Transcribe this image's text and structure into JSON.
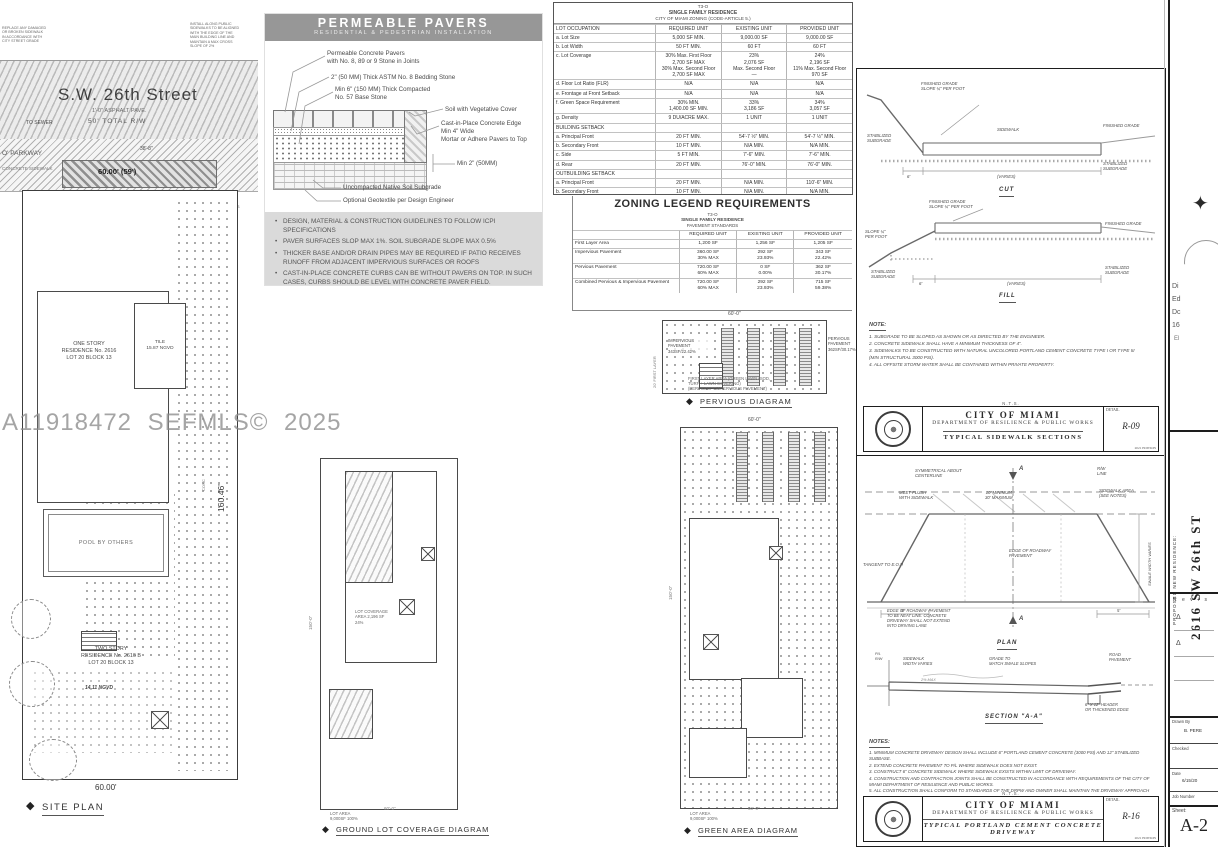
{
  "watermark": "A11918472 SEFMLS© 2025",
  "icons": {
    "diamond": "◆",
    "triangle": "Δ",
    "compass": "✦"
  },
  "site_plan": {
    "note_left": "REPLACE ANY DAMAGED\nOR BROKEN SIDEWALK\nIN ACCORDANCE WITH\nCITY STREET GRADE",
    "note_right": "INSTALL ALONG PUBLIC\nSIDEWALKS TO BE ALIGNED\nWITH THE EDGE OF THE\nMAIN BUILDING LINE AND\nMAINTAIN A MAX CROSS\nSLOPE OF 2%",
    "street_name": "S.W. 26th Street",
    "asphalt": "1'-0\" ASPHALT PAVE.",
    "total_rw": "50' TOTAL R/W",
    "to_sewer": "TO SEWER",
    "parkway": "O' PARKWAY",
    "sidewalk": "CONCRETE SIDEWALK",
    "drive_dim": "60.00' (59')",
    "dim_38": "38'-8\"",
    "drive_ticks": "8'-6\"      8'-6\"      8'-6\"      8'-6\"",
    "vis_triangles": "10'x10'\nVISIBILITY\nTRIANGLES",
    "one_story": "ONE STORY\nRESIDENCE No. 2616\nLOT 20 BLOCK 13",
    "tile": "TILE\n15.87 NGVD",
    "conc": "CONC",
    "pool": "POOL BY OTHERS",
    "two_story": "TWO STORY\nRESIDENCE No. 2616 B\nLOT 20 BLOCK 13",
    "ngvd": "14.11 NGVD",
    "side_dim": "160.46'",
    "bottom_dim": "60.00'",
    "label": "SITE PLAN"
  },
  "pavers": {
    "title": "PERMEABLE PAVERS",
    "subtitle": "RESIDENTIAL & PEDESTRIAN INSTALLATION",
    "callout_pavers": "Permeable Concrete Pavers\nwith No. 8, 89 or 9 Stone in Joints",
    "callout_bedding": "2\" (50 MM) Thick ASTM No. 8 Bedding Stone",
    "callout_base": "Min 6\" (150 MM) Thick Compacted\nNo. 57 Base Stone",
    "callout_soil": "Soil with Vegetative Cover",
    "callout_edge": "Cast-in-Place Concrete Edge\nMin 4\" Wide\nMortar or Adhere Pavers to Top",
    "callout_min2": "Min 2\" (50MM)",
    "callout_subgrade": "Uncompacted Native Soil Subgrade",
    "callout_geotextile": "Optional Geotextile per Design Engineer",
    "bullets": [
      "DESIGN, MATERIAL & CONSTRUCTION GUIDELINES TO FOLLOW ICPI SPECIFICATIONS",
      "PAVER SURFACES SLOP MAX 1%. SOIL SUBGRADE SLOPE MAX 0.5%",
      "THICKER BASE AND/OR DRAIN PIPES MAY BE REQUIRED IF PATIO RECEIVES RUNOFF FROM ADJACENT IMPERVIOUS SURFACES OR ROOFS",
      "CAST-IN-PLACE CONCRETE CURBS CAN BE WITHOUT PAVERS ON TOP. IN SUCH CASES, CURBS SHOULD BE LEVEL WITH CONCRETE PAVER FIELD."
    ]
  },
  "zoning_table": {
    "title1": "T3-O",
    "title2": "SINGLE FAMILY RESIDENCE",
    "title3": "CITY OF MIAMI ZONING (CODE-ARTICLE 5.)",
    "rows": [
      {
        "n": "LOT OCCUPATION",
        "r": "REQUIRED   UNIT",
        "e": "EXISTING   UNIT",
        "p": "PROVIDED   UNIT"
      },
      {
        "n": "a. Lot Size",
        "r": "5,000 SF MIN.",
        "e": "9,000.00 SF",
        "p": "9,000.00 SF"
      },
      {
        "n": "b. Lot Width",
        "r": "50 FT MIN.",
        "e": "60 FT",
        "p": "60 FT"
      },
      {
        "n": "c. Lot Coverage",
        "r": "30% Max. First Floor\n2,700 SF MAX\n30% Max. Second Floor\n2,700 SF MAX",
        "e": "23%\n2,076 SF\nMax. Second Floor\n—",
        "p": "24%\n2,196 SF\n11% Max. Second Floor\n970 SF"
      },
      {
        "n": "d. Floor Lot Ratio (FLR)",
        "r": "N/A",
        "e": "N/A",
        "p": "N/A"
      },
      {
        "n": "e. Frontage at Front Setback",
        "r": "N/A",
        "e": "N/A",
        "p": "N/A"
      },
      {
        "n": "f. Green Space Requirement",
        "r": "30% MIN.\n1,400.00 SF MIN.",
        "e": "33%\n3,186 SF",
        "p": "34%\n3,057 SF"
      },
      {
        "n": "g. Density",
        "r": "9 DU/ACRE MAX.",
        "e": "1 UNIT",
        "p": "1 UNIT"
      },
      {
        "n": "BUILDING SETBACK",
        "r": "",
        "e": "",
        "p": ""
      },
      {
        "n": "a. Principal Front",
        "r": "20 FT MIN.",
        "e": "54'-7 ½\" MIN.",
        "p": "54'-7 ½\" MIN."
      },
      {
        "n": "b. Secondary Front",
        "r": "10 FT MIN.",
        "e": "N/A MIN.",
        "p": "N/A MIN."
      },
      {
        "n": "c. Side",
        "r": "5 FT MIN.",
        "e": "7'-6\" MIN.",
        "p": "7'-6\" MIN."
      },
      {
        "n": "d. Rear",
        "r": "20 FT MIN.",
        "e": "76'-0\" MIN.",
        "p": "76'-0\" MIN."
      },
      {
        "n": "OUTBUILDING SETBACK",
        "r": "",
        "e": "",
        "p": ""
      },
      {
        "n": "a. Principal Front",
        "r": "20 FT MIN.",
        "e": "N/A MIN.",
        "p": "110'-6\" MIN."
      },
      {
        "n": "b. Secondary Front",
        "r": "10 FT MIN.",
        "e": "N/A MIN.",
        "p": "N/A MIN."
      },
      {
        "n": "c. Side",
        "r": "5 FT MIN.",
        "e": "N/A MIN.",
        "p": "5'-7 ⅞\" MIN."
      },
      {
        "n": "d. Rear",
        "r": "20 FT MIN.",
        "e": "N/A MIN.",
        "p": "20'-7\" MIN."
      },
      {
        "n": "BUILDING HEIGHT",
        "r": "",
        "e": "",
        "p": ""
      },
      {
        "n": "a. Principal Building",
        "r": "25 FT - 2 Stories",
        "e": "1 Story",
        "p": "1 Story"
      },
      {
        "n": "b. Outbuilding",
        "r": "25 FT - 2 Stories",
        "e": "N/A FT - 1 Story",
        "p": "N/A FT - 1 Story"
      },
      {
        "n": "PARKING",
        "r": "",
        "e": "",
        "p": ""
      },
      {
        "n": "Facade Width",
        "r": "60% Lot Width\n36 FT",
        "e": "17% Lot Width\n10 FT",
        "p": "60% Lot Width\n36 FT"
      }
    ]
  },
  "zoning_legend": {
    "title": "ZONING LEGEND REQUIREMENTS",
    "sub1": "T3-O",
    "sub2": "SINGLE FAMILY RESIDENCE",
    "sub3": "PAVEMENT STANDARDS",
    "rows": [
      {
        "n": "",
        "r": "REQUIRED   UNIT",
        "e": "EXISTING   UNIT",
        "p": "PROVIDED   UNIT"
      },
      {
        "n": "First Layer Area",
        "r": "1,200 SF",
        "e": "1,256 SF",
        "p": "1,205 SF"
      },
      {
        "n": "Impervious Pavement",
        "r": "360.00 SF\n30% MAX",
        "e": "292 SF\n23.93%",
        "p": "343 SF\n22.42%"
      },
      {
        "n": "Pervious Pavement",
        "r": "720.00 SF\n60% MAX",
        "e": "0 SF\n0.00%",
        "p": "362 SF\n30.17%"
      },
      {
        "n": "Combined Pervious & Impervious Pavement",
        "r": "720.00 SF\n60% MAX",
        "e": "292 SF\n23.93%",
        "p": "715 SF\n59.38%"
      }
    ]
  },
  "pervious": {
    "dim_top": "60'-0\"",
    "first_layer": "20' FIRST LAYER",
    "impervious": "IMPERVIOUS\nPAVEMENT\n343SF/22.42%",
    "pervious": "PERVIOUS\nPAVEMENT\n362SF/30.17%",
    "note": "FIRST LAYER AREA (GREEN LAWN (SOD,\nTURF + LAWN COVERING)\n(PERVIOUS + IMPERVIOUS PAVEMENT)",
    "label": "PERVIOUS DIAGRAM"
  },
  "ground": {
    "dim_side": "150'-0\"",
    "coverage": "LOT COVERAGE\nAREA 2,196 SF\n24%",
    "lot_area": "LOT AREA\n9,000SF  100%",
    "dim_bottom": "60'-0\"",
    "label": "GROUND LOT COVERAGE DIAGRAM"
  },
  "green": {
    "dim_top": "60'-0\"",
    "dim_side": "150'-0\"",
    "lot_area": "LOT AREA\n9,000SF  100%",
    "dim_bottom": "60'-0\"",
    "label": "GREEN AREA DIAGRAM"
  },
  "sidewalk_detail": {
    "fg_slope": "FINISHED GRADE\nSLOPE ¼\" PER FOOT",
    "stab_sub": "STABILIZED\nSUBGRADE",
    "sidewalk": "SIDEWALK",
    "fin_grade": "FINISHED GRADE",
    "stab_sub_r": "STABILIZED\nSUBGRADE",
    "dim6": "6'",
    "varies": "(VARIES)",
    "cut": "CUT",
    "fg_slope2": "FINISHED GRADE\nSLOPE ¼\" PER FOOT",
    "slope_left": "SLOPE ¼\"\nPER FOOT",
    "fin_grade2": "FINISHED GRADE",
    "stab_sub_l": "STABILIZED\nSUBGRADE",
    "stab_sub_r2": "STABILIZED\nSUBGRADE",
    "dim6b": "6'",
    "varies2": "(VARIES)",
    "fill": "FILL",
    "notes_title": "NOTE:",
    "notes": [
      "1.  SUBGRADE TO BE SLOPED AS SHOWN OR AS DIRECTED BY THE ENGINEER.",
      "2.  CONCRETE SIDEWALK SHALL HAVE A MINIMUM THICKNESS OF 4\".",
      "3.  SIDEWALKS TO BE CONSTRUCTED WITH NATURAL UNCOLORED PORTLAND CEMENT CONCRETE TYPE I OR TYPE III\n     (MIN STRUCTURAL 3000 PSI).",
      "4.  ALL OFFSITE STORM WATER SHALL BE CONTAINED WITHIN PRIVATE PROPERTY."
    ],
    "nts": "N.T.S.",
    "tb": {
      "city": "CITY OF MIAMI",
      "dept": "DEPARTMENT OF RESILIENCE & PUBLIC WORKS",
      "name": "TYPICAL SIDEWALK SECTIONS",
      "detail": "DETAIL",
      "no": "R-09",
      "edition": "2021 EDITION"
    }
  },
  "driveway_detail": {
    "sym": "SYMMETRICAL ABOUT\nCENTERLINE",
    "a_top": "A",
    "a_bot": "A",
    "rw_line": "R/W\nLINE",
    "sw_area": "SIDEWALK AREA\n(SEE NOTES)",
    "meet": "MEET FLUSH\nWITH SIDEWALK",
    "minmax": "10' MINIMUM\n30' MAXIMUM",
    "swale": "SWALE WIDTH VARIES",
    "edge": "EDGE OF ROADWAY\nPAVEMENT",
    "tangent": "TANGENT TO E.O.P.",
    "neat": "EDGE OF ROADWAY PAVEMENT\nTO BE NEAT LINE. CONCRETE\nDRIVEWAY SHALL NOT EXTEND\nINTO DRIVING LANE",
    "dim5a": "5'",
    "dim5b": "5'",
    "plan": "PLAN",
    "pl": "P/L\nR/W",
    "sw_width": "SIDEWALK\nWIDTH VARIES",
    "grade_match": "GRADE TO\nMATCH SWALE SLOPES",
    "road_pav": "ROAD\nPAVEMENT",
    "pct": "2% MAX",
    "header_lbl": "6\" X 12\" HEADER\nOR THICKENED EDGE",
    "section": "SECTION \"A-A\"",
    "notes_title": "NOTES:",
    "notes": [
      "1.  MINIMUM CONCRETE DRIVEWAY DESIGN SHALL INCLUDE 6\" PORTLAND CEMENT CONCRETE (3000 PSI) AND 12\" STABILIZED SUBBASE.",
      "2.  EXTEND CONCRETE PAVEMENT TO P/L WHERE SIDEWALK DOES NOT EXIST.",
      "3.  CONSTRUCT 6\" CONCRETE SIDEWALK WHERE SIDEWALK EXISTS WITHIN LIMIT OF DRIVEWAY.",
      "4.  CONSTRUCTION AND CONTRACTION JOINTS SHALL BE CONSTRUCTED IN ACCORDANCE WITH REQUIREMENTS OF THE CITY OF MIAMI DEPARTMENT OF RESILIENCE AND PUBLIC WORKS.",
      "5.  ALL CONSTRUCTION SHALL CONFORM TO STANDARDS OF THE DRPW AND OWNER SHALL MAINTAIN THE DRIVEWAY APPROACH WITHIN THE PUBLIC RIGHT OF WAY.",
      "6.  DRIVEWAY WIDTH TO COMPLY WITH DEPARTMENT OF RESILIENCE AND PUBLIC WORKS BULLETIN No. 28."
    ],
    "nts": "N.T.S.",
    "tb": {
      "city": "CITY OF MIAMI",
      "dept": "DEPARTMENT OF RESILIENCE & PUBLIC WORKS",
      "name": "TYPICAL PORTLAND CEMENT CONCRETE DRIVEWAY",
      "detail": "DETAIL",
      "no": "R-16",
      "edition": "2021 EDITION"
    }
  },
  "sidebar": {
    "frag1": "Di",
    "frag2": "Ed",
    "frag3": "Dc",
    "frag4": "16",
    "frag5": "El",
    "project_street": "2616  SW  26th  ST",
    "project_label": "PROPOSED NEW RESIDENCE:",
    "revisions": "R e v i s",
    "drawn_by_label": "Drawn By",
    "drawn_by": "B. PERE",
    "checked_label": "Checked",
    "date_label": "Date",
    "date_value": "6/15/20",
    "job_label": "Job Number",
    "sheet_label": "Sheet:",
    "sheet_no": "A-2"
  }
}
